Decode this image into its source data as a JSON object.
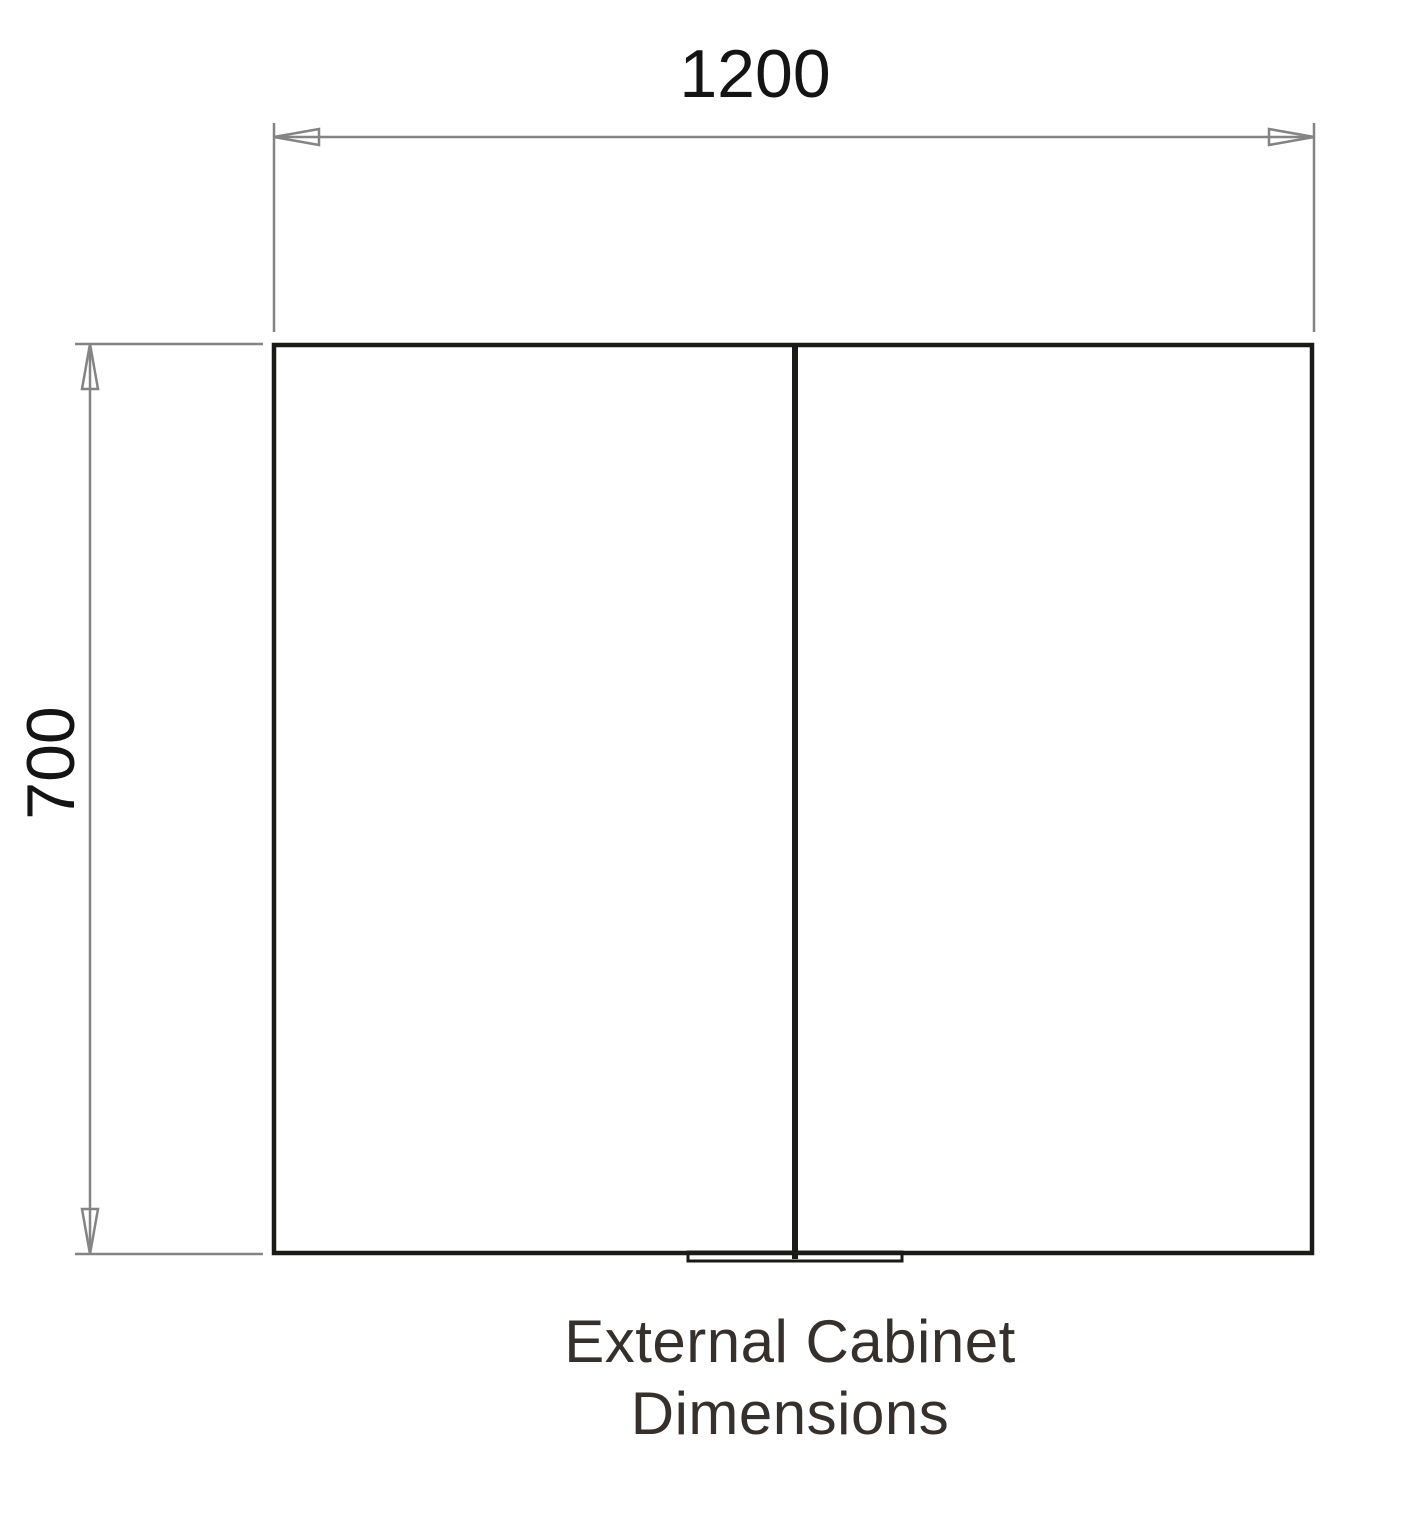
{
  "drawing": {
    "caption": {
      "line1": "External Cabinet",
      "line2": "Dimensions"
    },
    "width_dimension": {
      "value": "1200"
    },
    "height_dimension": {
      "value": "700"
    }
  },
  "colors": {
    "cabinet_outline": "#1a1a17",
    "dimension_lines": "#848484",
    "dimension_text": "#141414",
    "caption_text": "#35302c",
    "background": "#ffffff"
  }
}
